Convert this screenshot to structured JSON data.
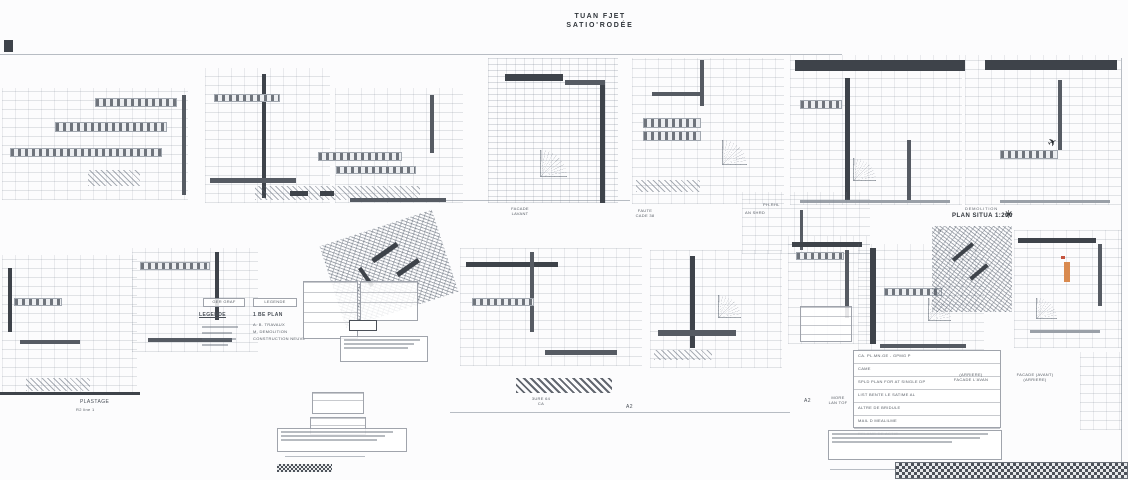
{
  "sheet_title": {
    "line1": "TUAN FJET",
    "line2": "SATIO'RODÉE"
  },
  "labels": {
    "facade_left_1": "FACADE",
    "facade_left_2": "LAVANT",
    "facade_right_1": "FAUTE",
    "facade_right_2": "CADE 38",
    "site_1": "DEMOLITION",
    "site_2": "PLAN SITUA 1:200",
    "site_n": "N°",
    "plan_left_1": "PLASTAGE",
    "plan_left_2": "R2 line 1",
    "plan_mid_1": "3URE 64",
    "plan_mid_2": "CA",
    "marker_a2_left": "A2",
    "marker_a2_right": "A2",
    "roof_1": "MORE",
    "roof_2": "LAN TOF",
    "detail_1": "PH-RHL",
    "detail_2": "AN SHRD",
    "caption_left_1": "(ARRIERE)",
    "caption_left_2": "FACADE L'AVAN",
    "caption_right_1": "FACADE (AVANT)",
    "caption_right_2": "(ARRIERE)"
  },
  "legend": {
    "header_left": "GER GRAF",
    "header_right": "LEGENDE",
    "sub_left": "LEGENDE",
    "sub_right": "1 BE PLAN",
    "item_1": "A. B. TRAVAUX",
    "item_2": "M. DEMOLITION",
    "item_3": "CONSTRUCTION NEUVE"
  },
  "title_block": {
    "row_1": "CA. PL.MN.GE - GPMG P",
    "row_2": "CAME",
    "row_3": "SPLD PLAN FOR AT SINGLE DP",
    "row_4": "LIST BENTE LE SATIME AL",
    "row_5": "ALTRE DE BRIDULE",
    "row_6": "MAIL D MEALILME",
    "row_7": "RELAME DE ACTIE"
  },
  "icons": {
    "north_star": "✳",
    "north_arrow": "✈"
  },
  "colors": {
    "accent_orange": "#d98a4f",
    "accent_red": "#c4543f",
    "wall_dark": "#4c5158",
    "line_gray": "#9aa1ab"
  }
}
